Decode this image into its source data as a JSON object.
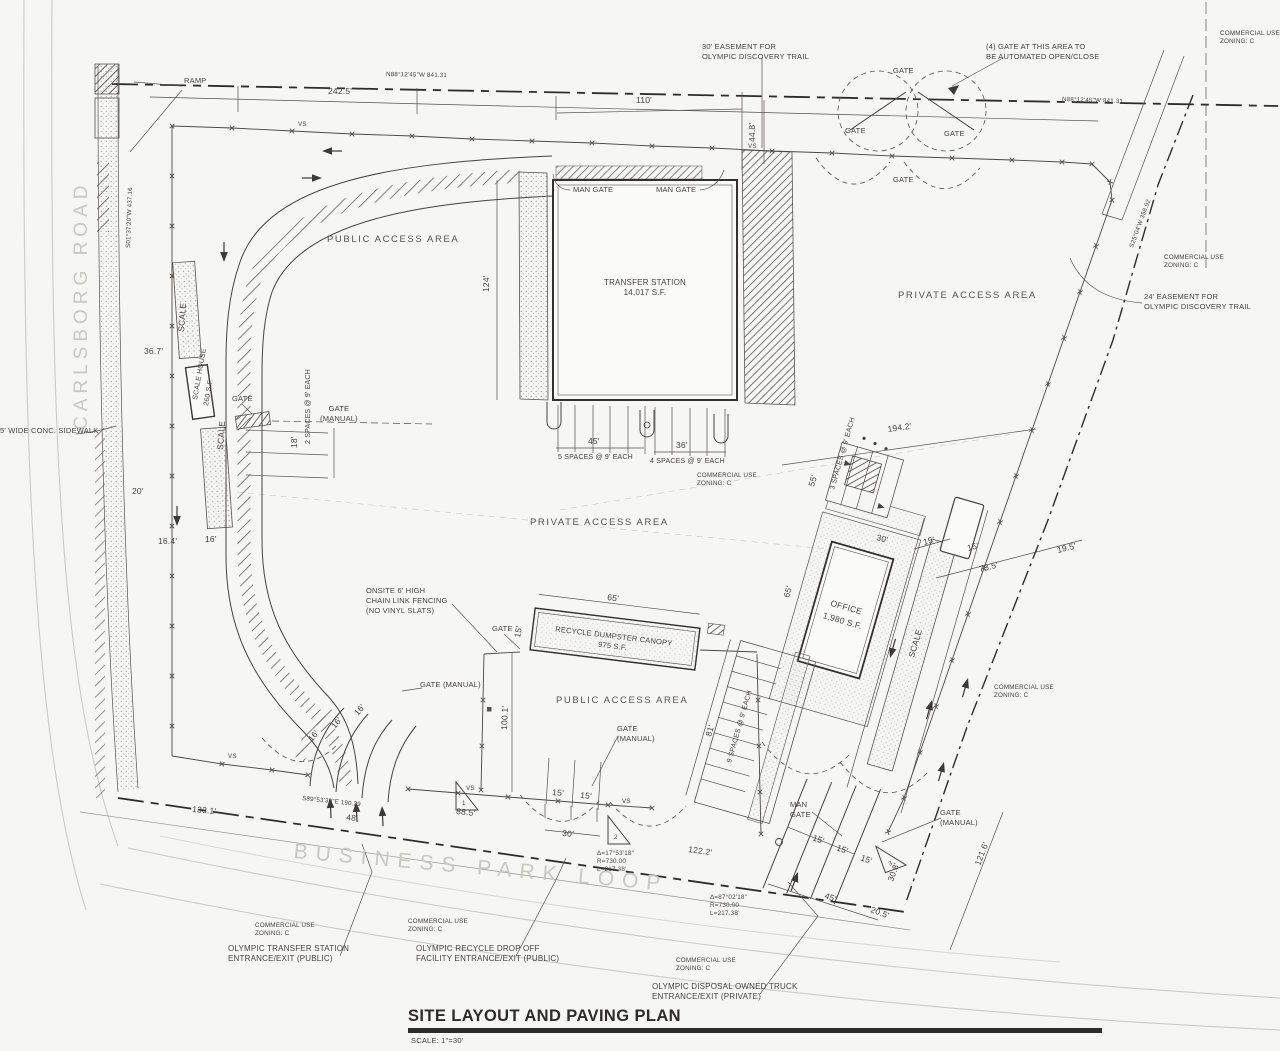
{
  "title_block": {
    "title": "SITE LAYOUT AND PAVING PLAN",
    "scale_note": "SCALE: 1\"=30'"
  },
  "streets": {
    "carlsborg": "CARLSBORG ROAD",
    "business_park": "BUSINESS PARK LOOP"
  },
  "areas": {
    "public": "PUBLIC ACCESS AREA",
    "private": "PRIVATE ACCESS AREA"
  },
  "buildings": {
    "transfer": "TRANSFER STATION\n14,017 S.F.",
    "office_name": "OFFICE",
    "office_size": "1,980 S.F.",
    "scale_house": "SCALE HOUSE",
    "scale_house_size": "260 S.F.",
    "canopy": "RECYCLE DUMPSTER CANOPY\n975 S.F.",
    "scale": "SCALE",
    "ramp": "RAMP"
  },
  "gates": {
    "gate": "GATE",
    "man_gate": "MAN GATE",
    "man_gate_2": "MAN\nGATE",
    "manual": "GATE (MANUAL)",
    "manual_2": "GATE\n(MANUAL)",
    "auto_note": "(4) GATE AT THIS AREA TO\nBE AUTOMATED OPEN/CLOSE"
  },
  "easements": {
    "top": "30' EASEMENT FOR\nOLYMPIC DISCOVERY TRAIL",
    "right": "24' EASEMENT FOR\nOLYMPIC DISCOVERY TRAIL"
  },
  "notes": {
    "sidewalk": "5' WIDE CONC. SIDEWALK",
    "fencing": "ONSITE 6' HIGH\nCHAIN LINK FENCING\n(NO VINYL SLATS)",
    "zoning": "COMMERCIAL USE\nZONING: C",
    "fence_vs": "VS"
  },
  "entrances": {
    "transfer": "OLYMPIC TRANSFER STATION\nENTRANCE/EXIT (PUBLIC)",
    "recycle": "OLYMPIC RECYCLE DROP OFF\nFACILITY ENTRANCE/EXIT (PUBLIC)",
    "truck": "OLYMPIC DISPOSAL OWNED TRUCK\nENTRANCE/EXIT (PRIVATE)"
  },
  "parking": {
    "five": "5 SPACES @ 9' EACH",
    "four": "4 SPACES @ 9' EACH",
    "two": "2 SPACES @ 9' EACH",
    "three": "3 SPACES @ 9' EACH",
    "nine": "9 SPACES @ 9' EACH"
  },
  "dims": {
    "d242_5": "242.5'",
    "d110": "110'",
    "d44_8": "44.8'",
    "d124": "124'",
    "d45": "45'",
    "d36": "36'",
    "d36_7": "36.7'",
    "d20": "20'",
    "d16_4": "16.4'",
    "d16": "16'",
    "d18": "18'",
    "d194_2": "194.2'",
    "d100_1": "100.1'",
    "d133_1": "133.1'",
    "d48": "48'",
    "d88_5": "88.5'",
    "d30": "30'",
    "d15": "15'",
    "d122_2": "122.2'",
    "d20_5": "20.5'",
    "d30_8": "30.8'",
    "d121_6": "121.6'",
    "d65": "65'",
    "d55": "55'",
    "d81": "81'",
    "d73_5": "73.5'",
    "d19_5": "19.5'"
  },
  "bearings": {
    "top": "N88°12'45\"W  841.31",
    "left": "S01°37'20\"W  437.16",
    "right": "S25°04'W  358.92",
    "bottom": "S89°53'30\"E  190.29"
  },
  "curves": {
    "c1": "Δ=17°53'18\"\nR=730.00\nL=217.38'",
    "c2": "Δ=87°02'18\"\nR=730.00\nL=217.38'",
    "n1": "1",
    "n2": "2",
    "n3": "3"
  }
}
